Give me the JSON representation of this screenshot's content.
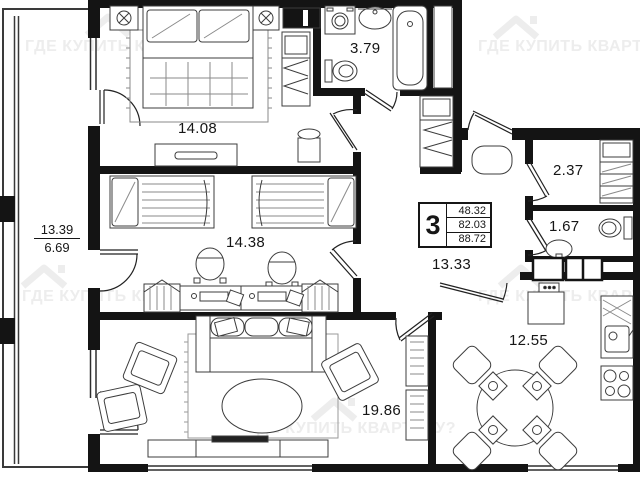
{
  "plan": {
    "watermark": {
      "text": "ГДЕ КУПИТЬ КВАРТИРУ?"
    },
    "rooms": {
      "bedroom": {
        "area": "14.08"
      },
      "bathroom": {
        "area": "3.79"
      },
      "kids_room": {
        "area": "14.38"
      },
      "hallway": {
        "area": "13.33"
      },
      "wardrobe": {
        "area": "2.37"
      },
      "wc": {
        "area": "1.67"
      },
      "kitchen": {
        "area": "12.55"
      },
      "living_room": {
        "area": "19.86"
      },
      "balcony": {
        "area_full": "13.39",
        "area_coeff": "6.69"
      }
    },
    "info_box": {
      "rooms_count": "3",
      "living_area": "48.32",
      "apartment_area": "82.03",
      "total_area": "88.72"
    }
  }
}
